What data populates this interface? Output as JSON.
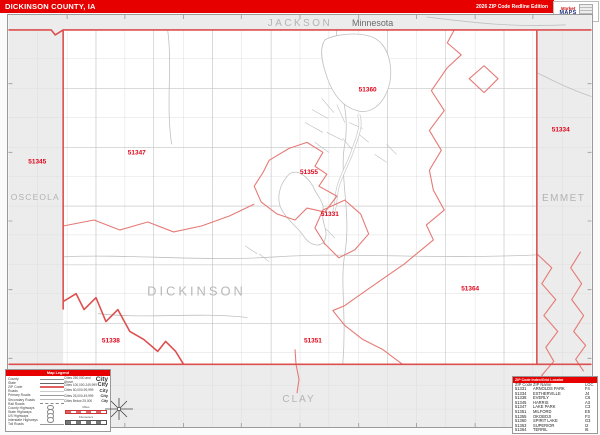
{
  "title_bar": {
    "title": "DICKINSON COUNTY, IA",
    "edition": "2026 ZIP Code Redline Edition"
  },
  "logo": {
    "brand_top": "Market",
    "brand_bottom": "MAPS"
  },
  "map": {
    "state_label": "Minnesota",
    "county_labels": {
      "north": "JACKSON",
      "west": "OSCEOLA",
      "east": "EMMET",
      "south": "CLAY",
      "center": "DICKINSON"
    },
    "zip_labels": [
      {
        "text": "51360"
      },
      {
        "text": "51347"
      },
      {
        "text": "51345"
      },
      {
        "text": "51334"
      },
      {
        "text": "51355"
      },
      {
        "text": "51331"
      },
      {
        "text": "51364"
      },
      {
        "text": "51338"
      },
      {
        "text": "51351"
      }
    ],
    "accent_colors": {
      "boundary_red": "#dd4f4f",
      "zip_line_red": "#e57a76",
      "zip_label_red": "#e00016",
      "neighbor_gray": "#ececec"
    }
  },
  "legend": {
    "title": "Map Legend",
    "line_items": [
      "County",
      "State",
      "ZIP Code",
      "Roads",
      "Primary Roads",
      "Secondary Roads",
      "Rail Roads",
      "County Highways",
      "State Highways",
      "US Highways",
      "Interstate Highways",
      "Toll Roads"
    ],
    "city_items": [
      "Cities 250,000 and Above",
      "Cities 100,000-249,999",
      "Cities 50,000-99,999",
      "Cities 25,000-49,999",
      "Cities Below 25,000"
    ],
    "city_glyph": "City",
    "scale_labels": [
      "Miles",
      "Kilometers"
    ]
  },
  "index_table": {
    "header": "ZIP Code Index/Grid Locator",
    "columns": [
      "ZIP Code",
      "ZIP Name",
      "LOC"
    ],
    "rows": [
      [
        "51331",
        "ARNOLDS PARK",
        "F4"
      ],
      [
        "51334",
        "ESTHERVILLE",
        "J4"
      ],
      [
        "51338",
        "EVERLY",
        "C6"
      ],
      [
        "51345",
        "HARRIS",
        "A3"
      ],
      [
        "51347",
        "LAKE PARK",
        "C3"
      ],
      [
        "51351",
        "MILFORD",
        "E5"
      ],
      [
        "51355",
        "OKOBOJI",
        "F3"
      ],
      [
        "51360",
        "SPIRIT LAKE",
        "G3"
      ],
      [
        "51363",
        "SUPERIOR",
        "I2"
      ],
      [
        "51364",
        "TERRIL",
        "I6"
      ]
    ]
  }
}
